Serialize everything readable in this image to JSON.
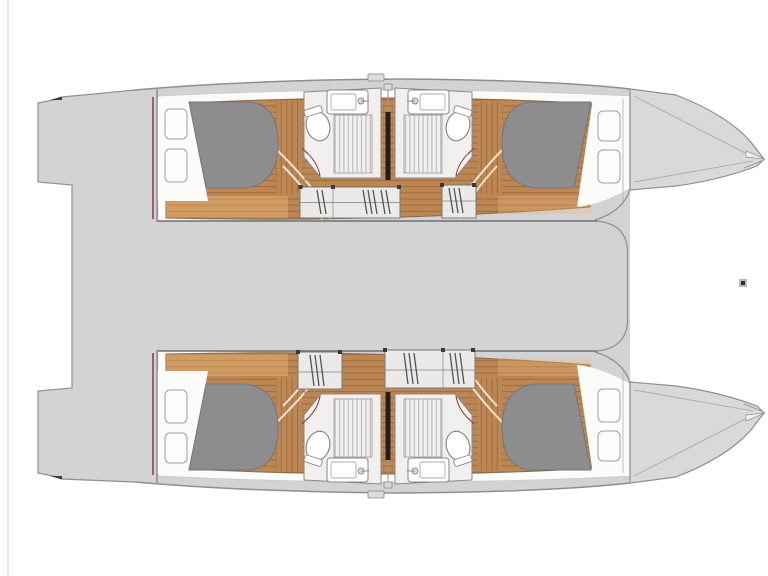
{
  "diagram": {
    "type": "yacht-deck-plan",
    "vessel": "catamaran",
    "view": "top-down interior layout, bows pointing right",
    "hulls": [
      {
        "name": "port hull (top)",
        "aft_cabin": {
          "berth": "double berth with grey mattress",
          "pillows": 2
        },
        "forward_cabin": {
          "berth": "double berth with grey mattress",
          "pillows": 2
        },
        "heads": [
          {
            "fixtures": [
              "toilet",
              "sink with faucet",
              "shower grating"
            ]
          },
          {
            "fixtures": [
              "toilet",
              "sink with faucet",
              "shower grating"
            ]
          }
        ],
        "companionways": 2
      },
      {
        "name": "starboard hull (bottom)",
        "aft_cabin": {
          "berth": "double berth with grey mattress",
          "pillows": 2
        },
        "forward_cabin": {
          "berth": "double berth with grey mattress",
          "pillows": 2
        },
        "heads": [
          {
            "fixtures": [
              "toilet",
              "sink with faucet",
              "shower grating"
            ]
          },
          {
            "fixtures": [
              "toilet",
              "sink with faucet",
              "shower grating"
            ]
          }
        ],
        "companionways": 2
      }
    ],
    "deck_areas": [
      "aft cockpit / bridge deck",
      "transom steps (left)",
      "bow lockers (right)"
    ]
  },
  "colors": {
    "background": "#ffffff",
    "deck": "#d3d3d5",
    "bow": "#d9d9db",
    "hull_interior": "#fbfbf9",
    "wood": "#bd8754",
    "wood_seam": "#6b4522",
    "walkway_tint": "#e9b97a",
    "mattress": "#8d8d8f",
    "pillow": "#fcfcfc",
    "bathroom_floor": "#f1f0ee",
    "fixture": "#ffffff",
    "grating": "#bdbdbd",
    "steps": "#ebeae8",
    "hatch": "#555555",
    "outline": "#8f8f8f",
    "dark_line": "#1f1f1f",
    "maroon": "#8c3a3a",
    "edge_artifact": "#e6e6e6",
    "cursor_mark": "#2e2e2e"
  }
}
